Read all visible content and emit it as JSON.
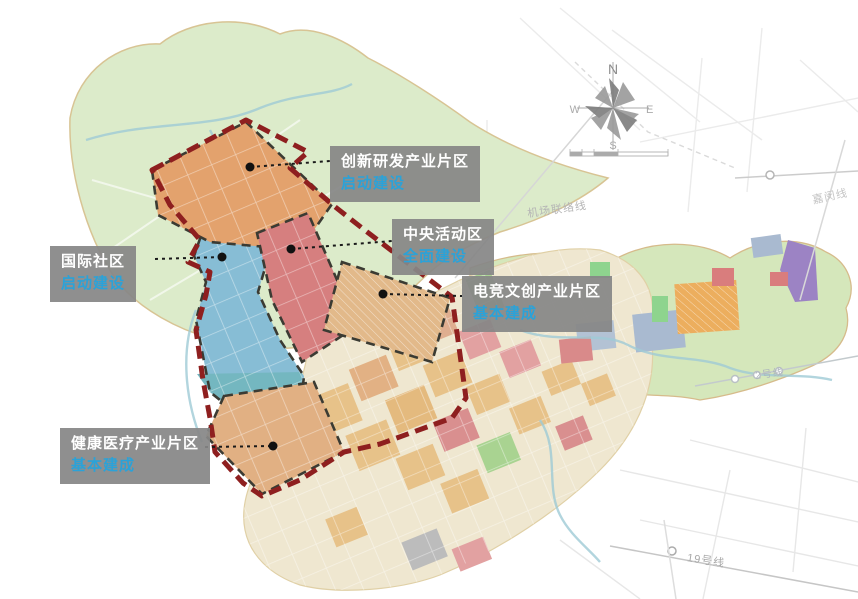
{
  "zone_labels": {
    "innovation": {
      "title": "创新研发产业片区",
      "status": "启动建设"
    },
    "central": {
      "title": "中央活动区",
      "status": "全面建设"
    },
    "esports": {
      "title": "电竞文创产业片区",
      "status": "基本建成"
    },
    "international": {
      "title": "国际社区",
      "status": "启动建设"
    },
    "health": {
      "title": "健康医疗产业片区",
      "status": "基本建成"
    }
  },
  "transit_labels": {
    "airport_link": "机场联络线",
    "jiamin_line": "嘉闵线",
    "line_2": "2号线",
    "line_19": "19号线"
  },
  "compass": {
    "north": "N",
    "east": "E",
    "south": "S",
    "west": "W"
  },
  "colors": {
    "master_boundary_red": "#8e1f1f",
    "zone_dash_black": "#3b3b33",
    "label_background_gray": "#868686",
    "label_title_white": "#ffffff",
    "label_status_blue": "#2ba2d8",
    "innovation_fill": "#e3a26d",
    "international_fill": "#87bdd5",
    "international_lower_teal": "#74b7c0",
    "central_fill": "#d67f7f",
    "esports_fill": "#e2b98a",
    "health_fill": "#e1b083",
    "north_district_green": "#dcebca",
    "east_corridor_green": "#d5e7bb",
    "south_city_cream": "#efe7d0"
  }
}
